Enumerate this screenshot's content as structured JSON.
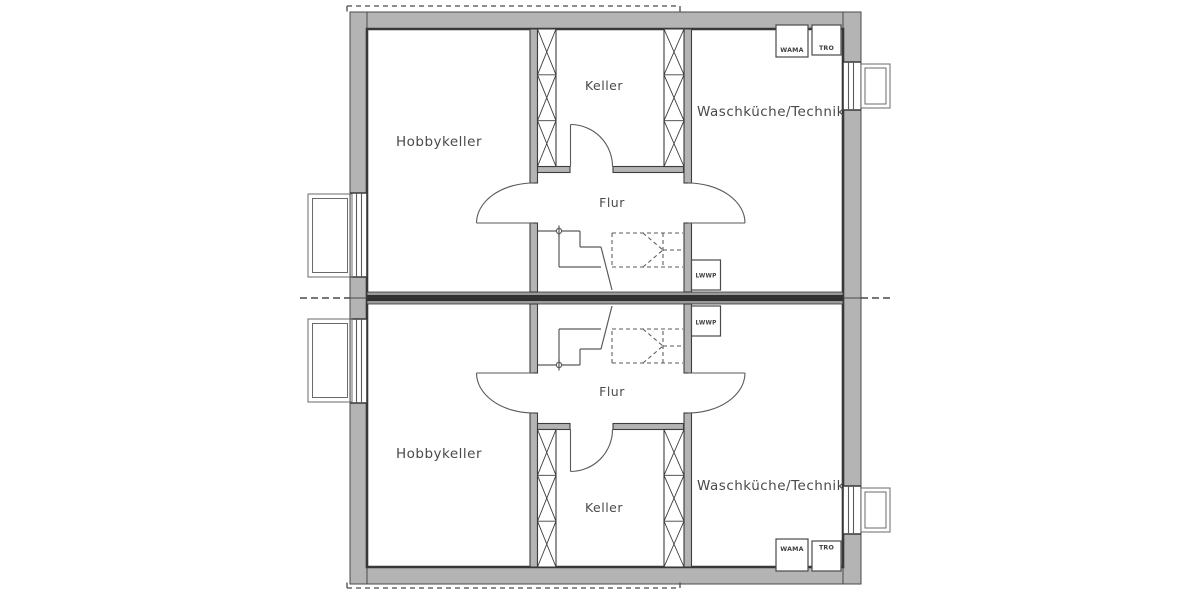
{
  "colors": {
    "background": "#ffffff",
    "wall_fill": "#b4b4b4",
    "wall_outline": "#3d3d3d",
    "inner_face_line": "#383838",
    "party_wall_core": "#303030",
    "thin_line": "#5a5a5a",
    "label_text": "#4a4a4a"
  },
  "units": [
    {
      "id": "unit-top",
      "rooms": {
        "hobbykeller": "Hobbykeller",
        "keller": "Keller",
        "waschkueche_technik": "Waschküche/Technik",
        "flur": "Flur"
      },
      "appliances": {
        "wama": "WAMA",
        "tro": "TRO",
        "lwwp": "LWWP"
      }
    },
    {
      "id": "unit-bottom",
      "rooms": {
        "hobbykeller": "Hobbykeller",
        "keller": "Keller",
        "waschkueche_technik": "Waschküche/Technik",
        "flur": "Flur"
      },
      "appliances": {
        "wama": "WAMA",
        "tro": "TRO",
        "lwwp": "LWWP"
      }
    }
  ]
}
